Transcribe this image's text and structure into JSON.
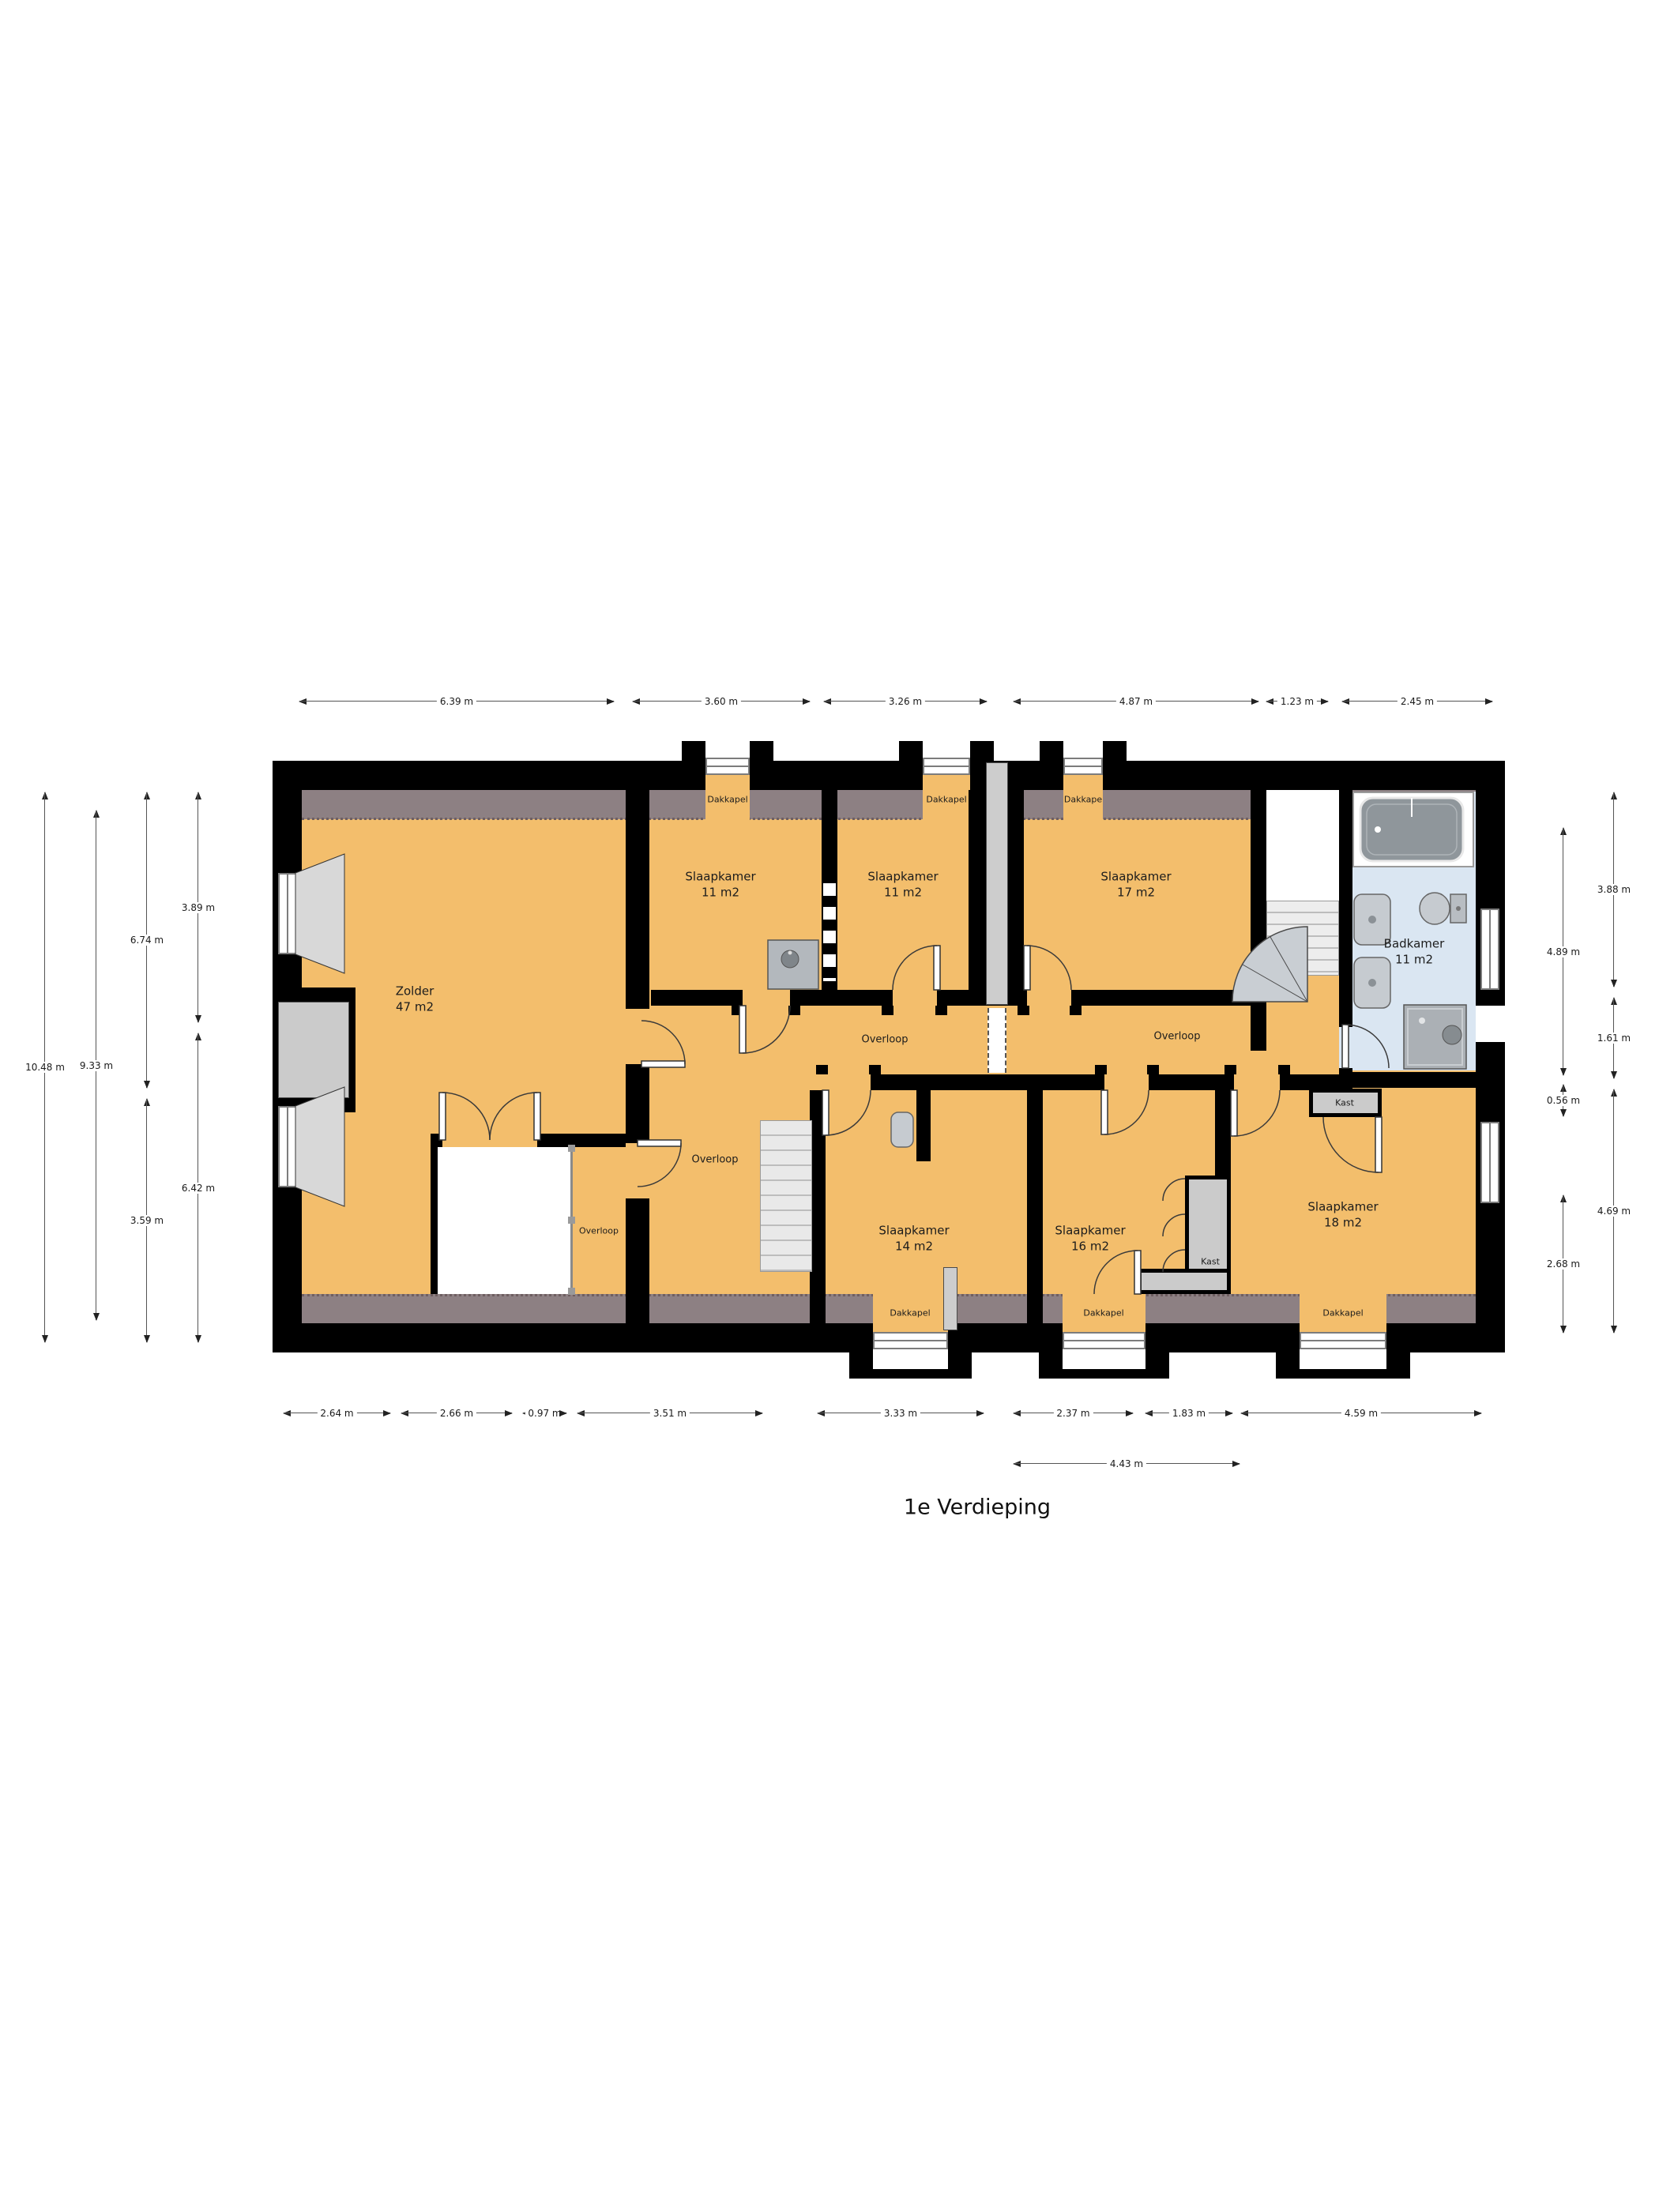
{
  "title": "1e Verdieping",
  "rooms": {
    "zolder": {
      "name": "Zolder",
      "area": "47 m2"
    },
    "slaapkamer_a": {
      "name": "Slaapkamer",
      "area": "11 m2"
    },
    "slaapkamer_b": {
      "name": "Slaapkamer",
      "area": "11 m2"
    },
    "slaapkamer_c": {
      "name": "Slaapkamer",
      "area": "17 m2"
    },
    "badkamer": {
      "name": "Badkamer",
      "area": "11 m2"
    },
    "slaapkamer_d": {
      "name": "Slaapkamer",
      "area": "14 m2"
    },
    "slaapkamer_e": {
      "name": "Slaapkamer",
      "area": "16 m2"
    },
    "slaapkamer_f": {
      "name": "Slaapkamer",
      "area": "18 m2"
    }
  },
  "corridors": {
    "overloop_west": "Overloop",
    "overloop_east": "Overloop",
    "overloop_hall": "Overloop",
    "overloop_passage": "Overloop"
  },
  "closets": {
    "kast_bath": "Kast",
    "kast_bedroom": "Kast"
  },
  "dormers": {
    "top": [
      "Dakkapel",
      "Dakkapel",
      "Dakkape"
    ],
    "bottom": [
      "Dakkapel",
      "Dakkapel",
      "Dakkapel"
    ]
  },
  "dimensions": {
    "top": [
      "6.39 m",
      "3.60 m",
      "3.26 m",
      "4.87 m",
      "1.23 m",
      "2.45 m"
    ],
    "bottom": [
      "2.64 m",
      "2.66 m",
      "0.97 m",
      "3.51 m",
      "3.33 m",
      "2.37 m",
      "1.83 m",
      "4.59 m"
    ],
    "bottom_row2": [
      "4.43 m"
    ],
    "left": [
      "10.48 m",
      "9.33 m",
      "6.74 m",
      "3.59 m",
      "3.89 m",
      "6.42 m"
    ],
    "right": [
      "4.89 m",
      "0.56 m",
      "2.68 m",
      "3.88 m",
      "1.61 m",
      "4.69 m"
    ]
  },
  "colors": {
    "floor": "#F3BE6C",
    "roof_band": "#8D8083",
    "bathroom_floor": "#DAE6F2",
    "wall": "#000000",
    "closet": "#CBCBCB",
    "fixture": "#C6CBD0"
  }
}
